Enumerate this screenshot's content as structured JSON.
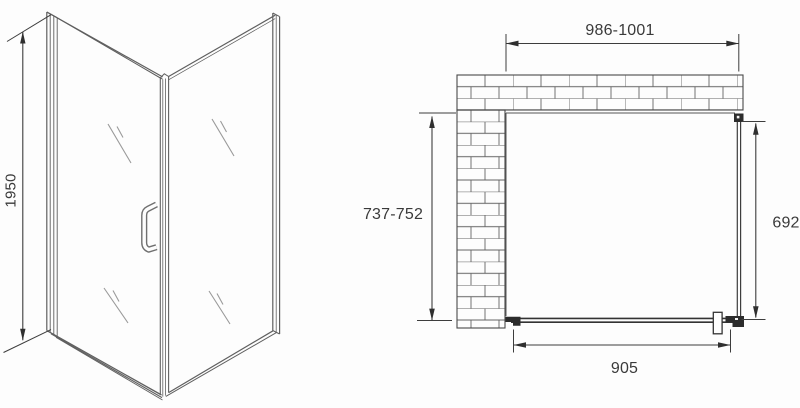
{
  "colors": {
    "line": "#4a4a4a",
    "light_line": "#6b6b6b",
    "brick_line": "#636363",
    "text": "#3a3a3a",
    "fill_dark": "#2c2c2c",
    "background": "#fdfdfd"
  },
  "front_view": {
    "height_label": "1950"
  },
  "plan_view": {
    "width_label": "986-1001",
    "depth_label": "737-752",
    "side_panel_label": "692",
    "door_label": "905"
  }
}
